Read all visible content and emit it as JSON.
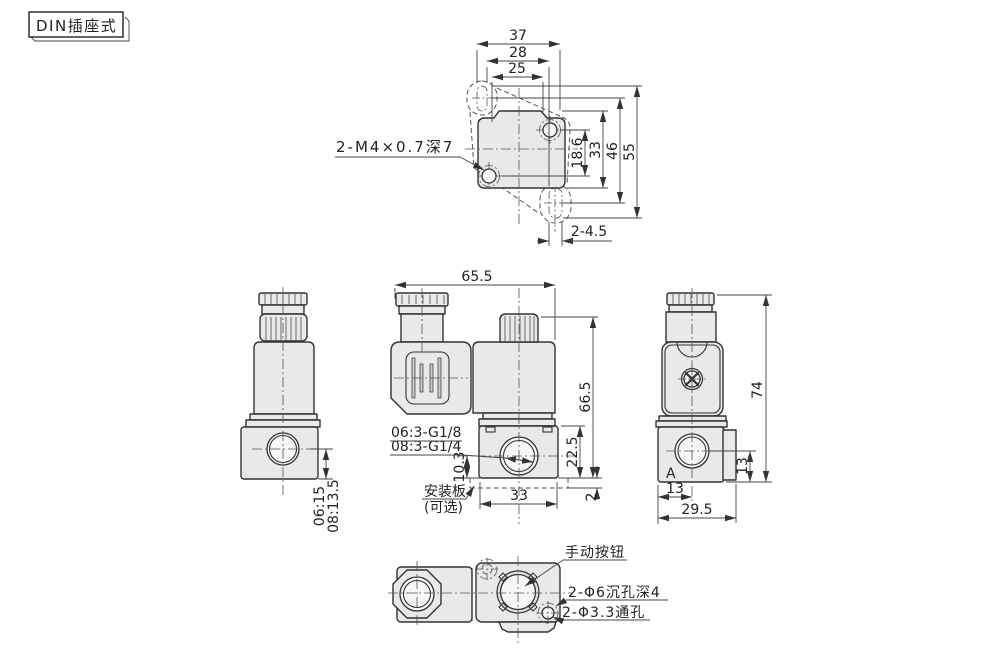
{
  "page": {
    "product_label": "DIN插座式"
  },
  "colors": {
    "line": "#333333",
    "fill_light": "#e9e9e9",
    "background": "#ffffff",
    "dim_line": "#444444"
  },
  "top_view": {
    "dim_overall_width": "37",
    "dim_width_28": "28",
    "dim_hole_spacing": "25",
    "dim_18_6": "18.6",
    "dim_body_height": "33",
    "dim_46": "46",
    "dim_55": "55",
    "dim_mount_holes": "2-4.5",
    "thread_note": "2-M4×0.7深7"
  },
  "front_view": {
    "dim_overall_width": "65.5",
    "dim_overall_height": "66.5",
    "port_thread_06": "06:3-G1/8",
    "port_thread_08": "08:3-G1/4",
    "dim_port_center": "10.3",
    "dim_body_width": "33",
    "dim_body_height": "22.5",
    "dim_plate_thickness": "2",
    "mount_plate_line1": "安装板",
    "mount_plate_line2": "(可选)"
  },
  "left_view": {
    "dim_port_center_06": "06:15",
    "dim_port_center_08": "08:13.5"
  },
  "right_view": {
    "dim_overall_height": "74",
    "dim_port_v": "13",
    "dim_port_h": "13",
    "dim_body_width": "29.5",
    "port_label": "A"
  },
  "bottom_view": {
    "manual_button_label": "手动按钮",
    "counterbore_note": "2-Φ6沉孔深4",
    "through_hole_note": "2-Φ3.3通孔"
  }
}
